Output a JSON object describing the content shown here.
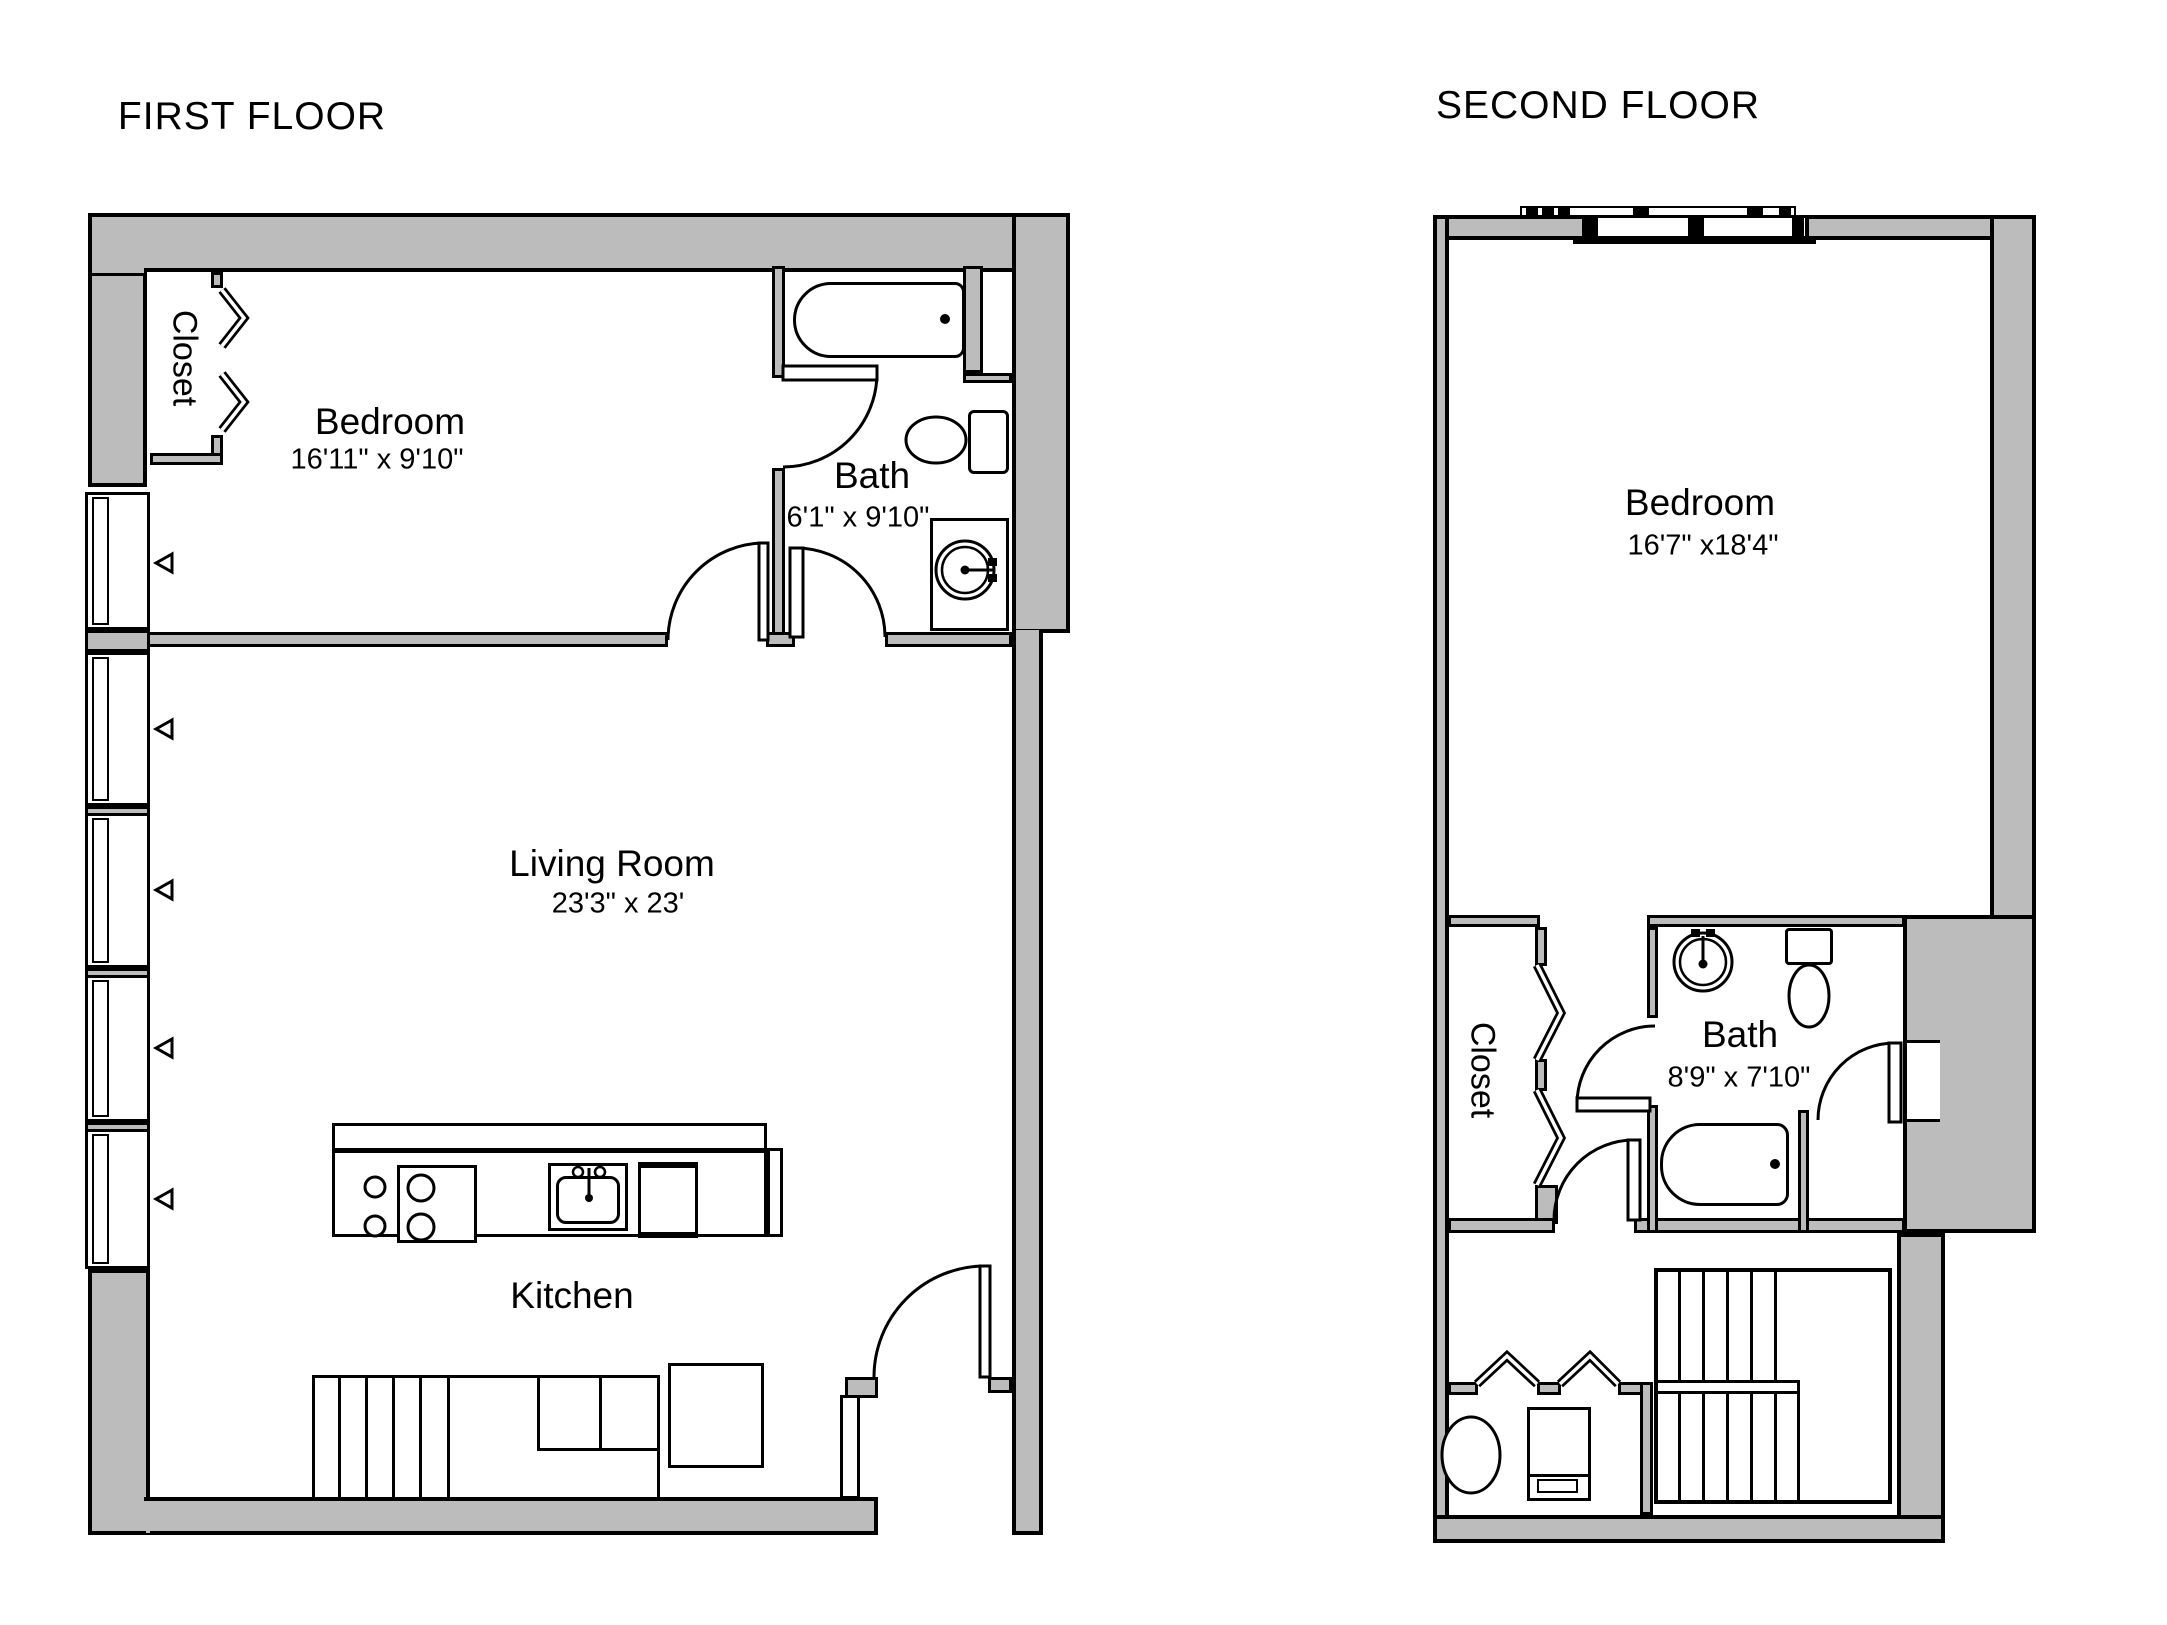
{
  "colors": {
    "wall_fill": "#bcbcbc",
    "line": "#000000",
    "floor_fill": "#ffffff"
  },
  "floors": {
    "first": {
      "title": "FIRST FLOOR",
      "rooms": {
        "closet": {
          "name": "Closet"
        },
        "bedroom": {
          "name": "Bedroom",
          "dims": "16'11\" x 9'10\""
        },
        "bath": {
          "name": "Bath",
          "dims": "6'1\" x 9'10\""
        },
        "living": {
          "name": "Living Room",
          "dims": "23'3\" x 23'"
        },
        "kitchen": {
          "name": "Kitchen"
        }
      }
    },
    "second": {
      "title": "SECOND FLOOR",
      "rooms": {
        "bedroom": {
          "name": "Bedroom",
          "dims": "16'7\" x18'4\""
        },
        "closet": {
          "name": "Closet"
        },
        "bath": {
          "name": "Bath",
          "dims": "8'9\" x 7'10\""
        }
      }
    }
  }
}
